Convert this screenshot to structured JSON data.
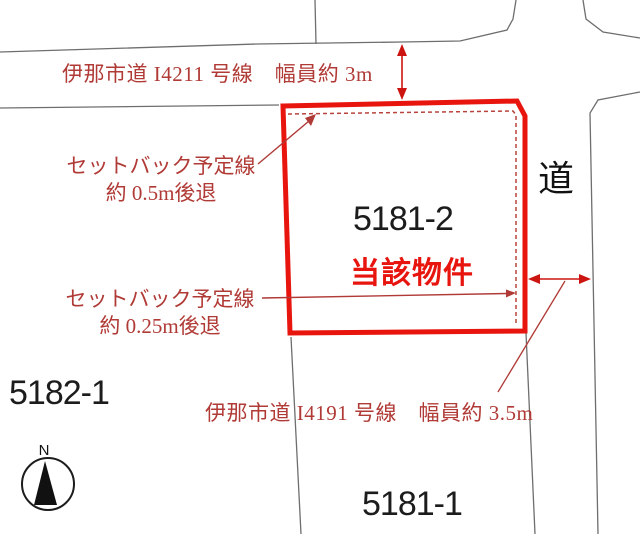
{
  "map": {
    "roads": {
      "north": {
        "label": "伊那市道 I4211 号線　幅員約 3m"
      },
      "south": {
        "label": "伊那市道 I4191 号線　幅員約 3.5m"
      },
      "east": {
        "label": "道"
      }
    },
    "parcels": {
      "subject": {
        "number": "5181-2",
        "designation": "当該物件"
      },
      "west": {
        "number": "5182-1"
      },
      "south": {
        "number": "5181-1"
      }
    },
    "setbacks": {
      "north": {
        "line1": "セットバック予定線",
        "line2": "約 0.5m後退"
      },
      "east": {
        "line1": "セットバック予定線",
        "line2": "約 0.25m後退"
      }
    },
    "compass": {
      "label": "N"
    }
  },
  "colors": {
    "parcel_outline_red": "#e8150f",
    "setback_dash_red": "#b8433c",
    "annotation_red": "#b03a36",
    "arrow_red": "#cc1510",
    "road_line_gray": "#6e6e6e",
    "text_black": "#1c1c1c"
  }
}
